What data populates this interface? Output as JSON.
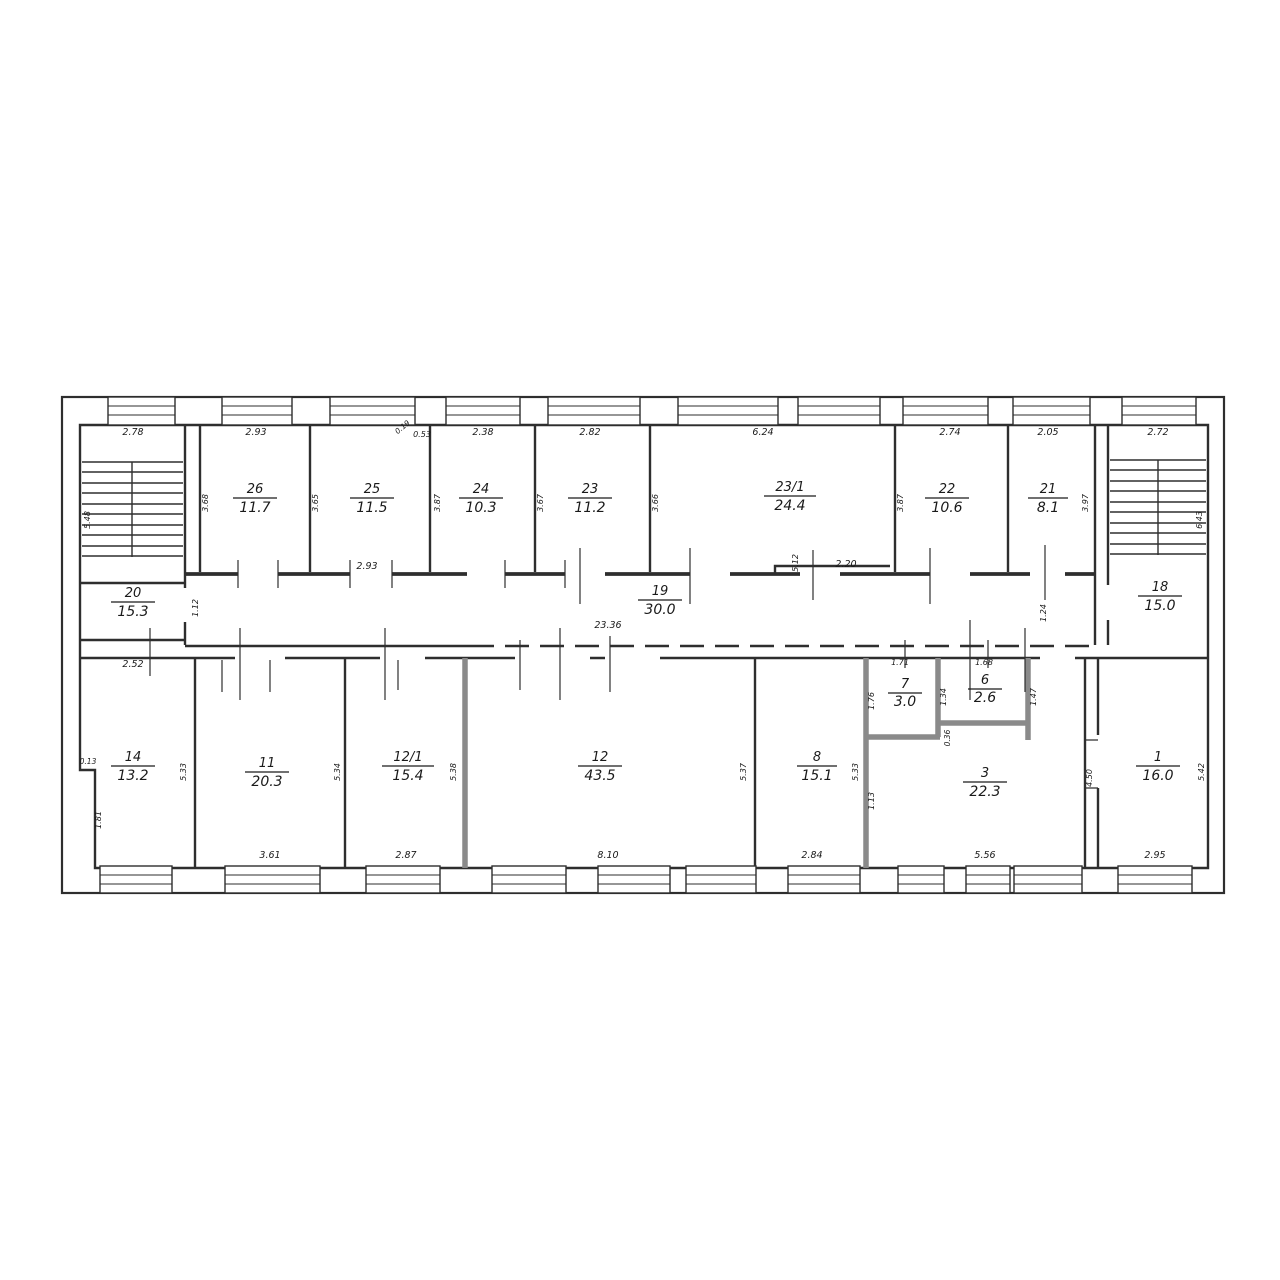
{
  "plan_title": "floor-plan",
  "watermark": {
    "text": "Avito"
  },
  "rooms": {
    "r26": {
      "number": "26",
      "area": "11.7"
    },
    "r25": {
      "number": "25",
      "area": "11.5"
    },
    "r24": {
      "number": "24",
      "area": "10.3"
    },
    "r23": {
      "number": "23",
      "area": "11.2"
    },
    "r23_1": {
      "number": "23/1",
      "area": "24.4"
    },
    "r22": {
      "number": "22",
      "area": "10.6"
    },
    "r21": {
      "number": "21",
      "area": "8.1"
    },
    "r20": {
      "number": "20",
      "area": "15.3"
    },
    "r19": {
      "number": "19",
      "area": "30.0"
    },
    "r18": {
      "number": "18",
      "area": "15.0"
    },
    "r14": {
      "number": "14",
      "area": "13.2"
    },
    "r11": {
      "number": "11",
      "area": "20.3"
    },
    "r12_1": {
      "number": "12/1",
      "area": "15.4"
    },
    "r12": {
      "number": "12",
      "area": "43.5"
    },
    "r8": {
      "number": "8",
      "area": "15.1"
    },
    "r7": {
      "number": "7",
      "area": "3.0"
    },
    "r6": {
      "number": "6",
      "area": "2.6"
    },
    "r3": {
      "number": "3",
      "area": "22.3"
    },
    "r1": {
      "number": "1",
      "area": "16.0"
    }
  },
  "dims": {
    "stair_l_top": "2.78",
    "r26_top": "2.93",
    "r25_small_a": "0.19",
    "r25_small_b": "0.53",
    "r24_top": "2.38",
    "r23_top": "2.82",
    "r23_1_top": "6.24",
    "r22_top": "2.74",
    "r21_top": "2.05",
    "stair_r_top": "2.72",
    "stair_l_h": "5.48",
    "r26_h": "3.68",
    "r25_h": "3.65",
    "r24_h": "3.87",
    "r23_h": "3.67",
    "r23_1_h": "3.66",
    "r22_h": "3.87",
    "r21_h": "3.97",
    "stair_r_h": "6.43",
    "r25_door": "2.93",
    "r23_1_step_v": "5.12",
    "r23_1_step": "2.20",
    "r20_door": "1.12",
    "corridor_len": "23.36",
    "r18_door": "1.24",
    "r14_top": "2.52",
    "r7_top": "1.71",
    "r6_top": "1.68",
    "r14_h": "5.33",
    "r11_h": "5.34",
    "r12_1_h": "5.38",
    "r12_h": "5.37",
    "r8_h": "5.33",
    "r1_h": "5.42",
    "r14_notch": "0.13",
    "r14_notch_h": "1.81",
    "r7_h": "1.76",
    "r6_l": "1.34",
    "r6_r": "1.47",
    "r6_b": "0.36",
    "r3_l": "1.13",
    "r1_door": "4.50",
    "r11_b": "3.61",
    "r12_1_b": "2.87",
    "r12_b": "8.10",
    "r8_b": "2.84",
    "r3_b": "5.56",
    "r1_b": "2.95"
  }
}
